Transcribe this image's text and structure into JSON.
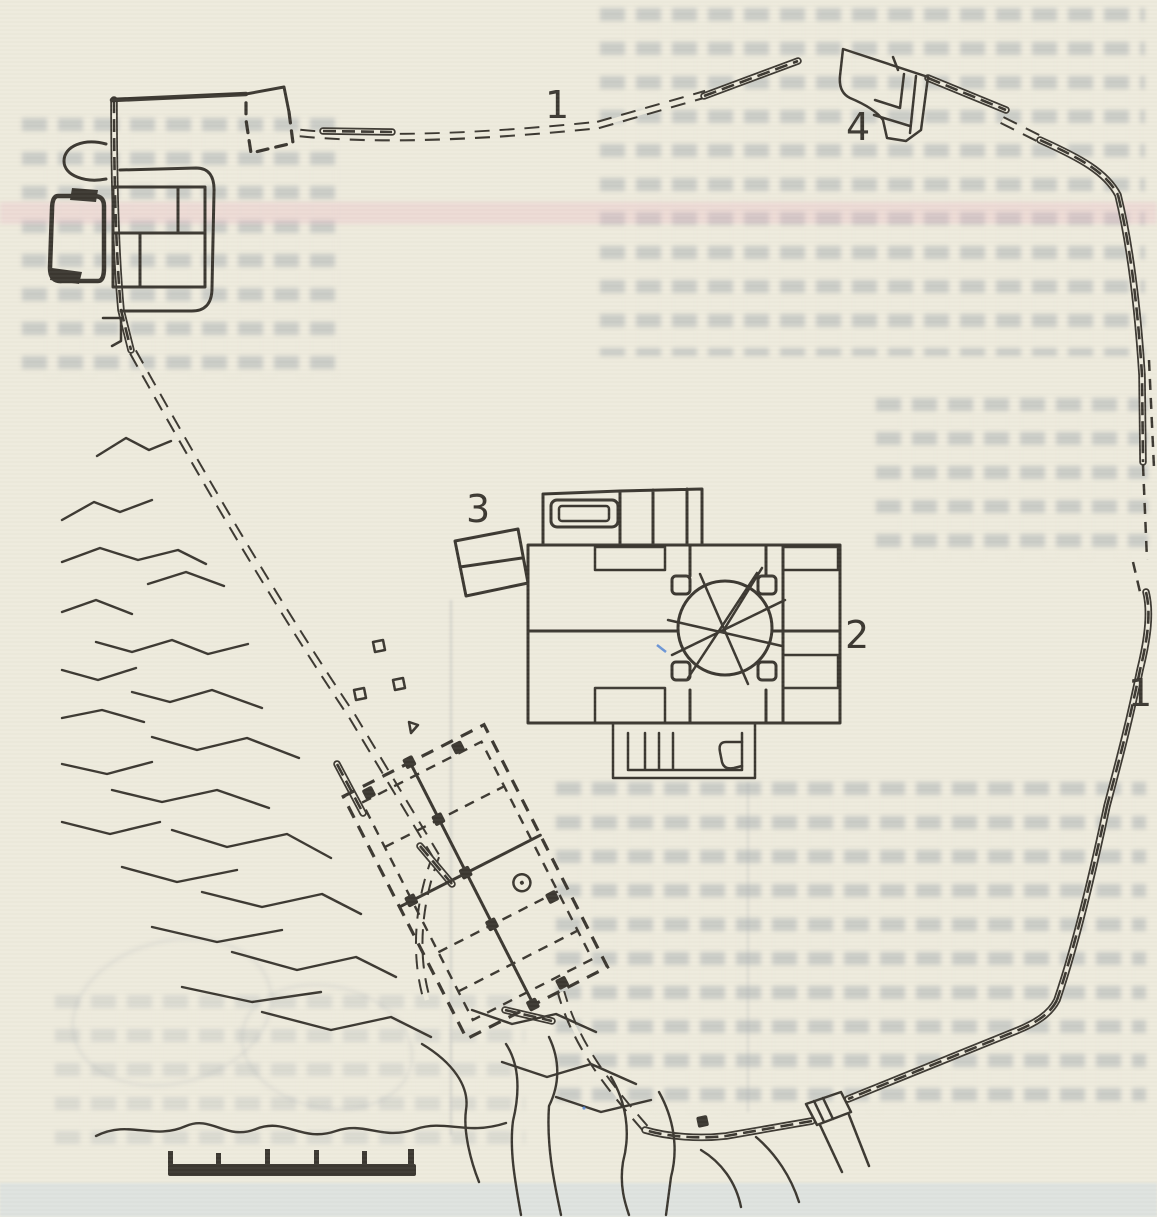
{
  "figure": {
    "kind": "scanned archaeological site plan",
    "labels": {
      "wall_north": "1",
      "wall_east": "1",
      "central_building": "2",
      "small_building": "3",
      "north_gate": "4"
    },
    "scale_bar": {
      "tick_count": 6,
      "segment_count": 5
    }
  },
  "colors": {
    "paper": "#edeadc",
    "ink": "#3a362f",
    "pen_mark": "#4a7fd4"
  }
}
